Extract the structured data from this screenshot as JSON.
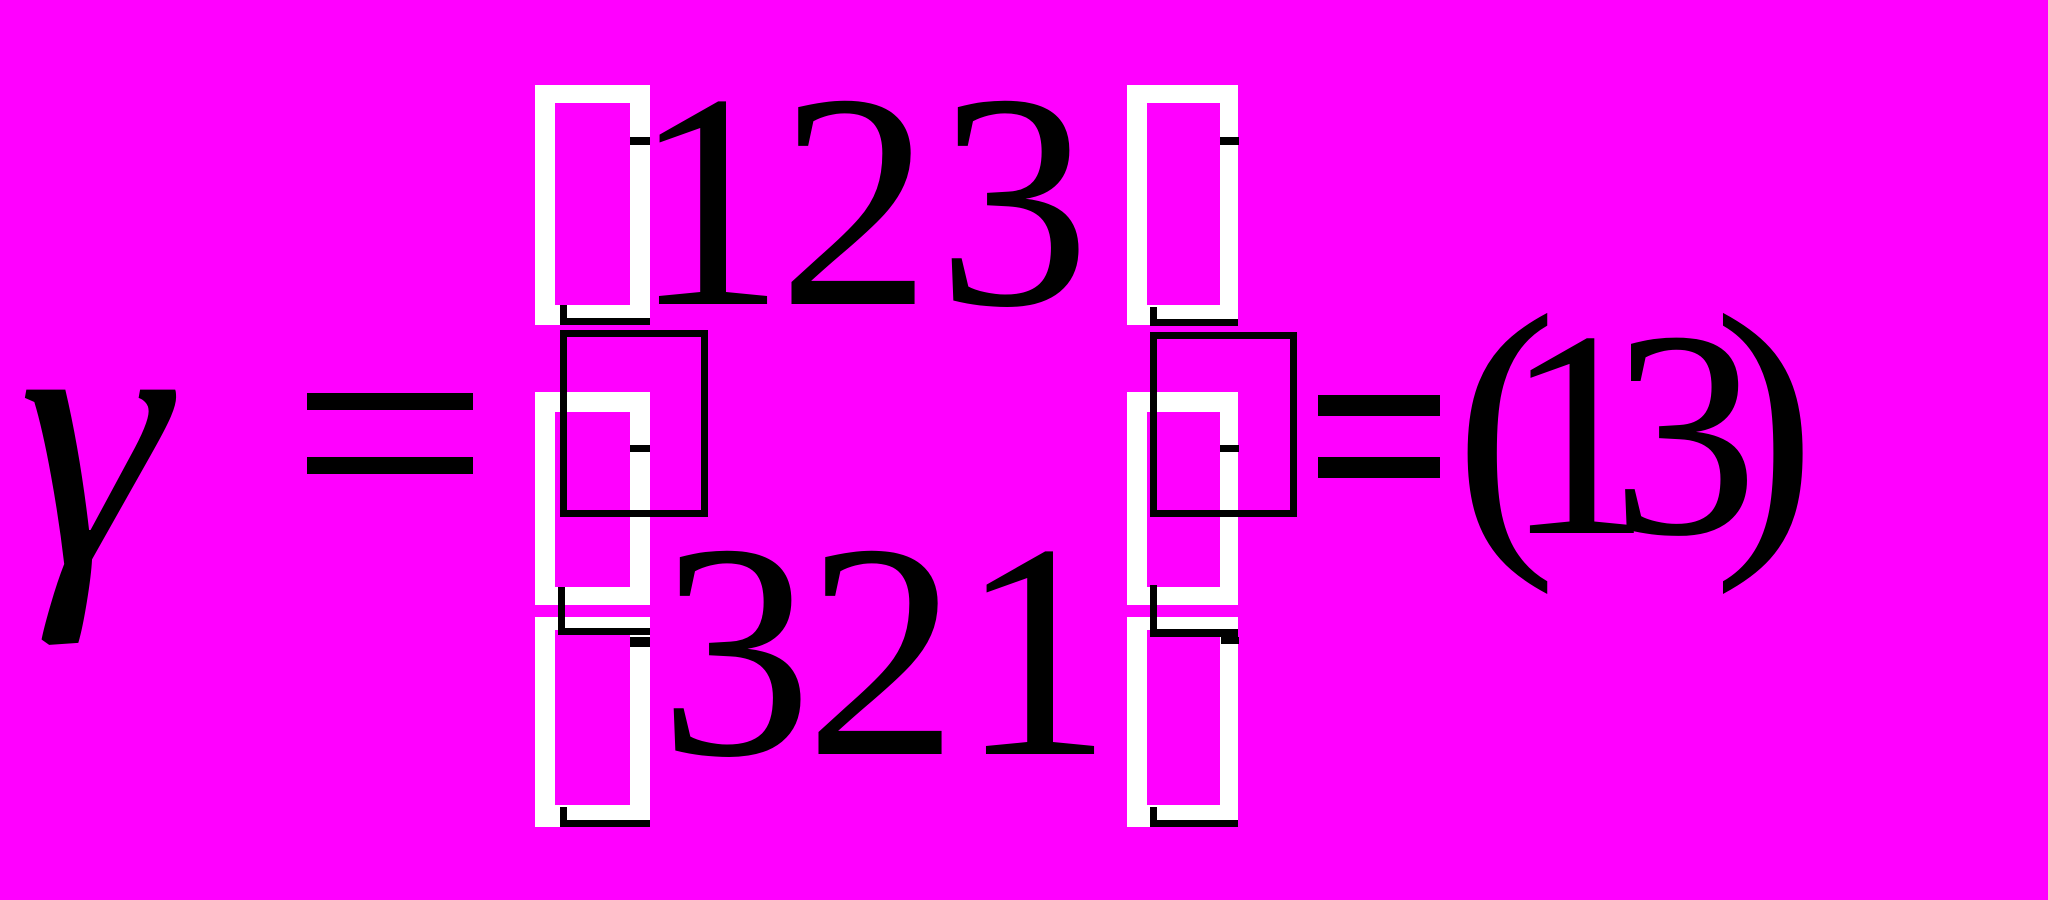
{
  "colors": {
    "background": "#FF00FF",
    "ink": "#000000",
    "missing_glyph_box": "#FFFFFF"
  },
  "formula": {
    "lhs_symbol": "γ",
    "equals_sign_1": "=",
    "matrix": {
      "rows": [
        [
          "1",
          "2",
          "3"
        ],
        [
          "3",
          "2",
          "1"
        ]
      ],
      "row1_text": "123",
      "row2_text": "321"
    },
    "equals_sign_2": "=",
    "result": {
      "chars": [
        "(",
        "1",
        "3",
        ")"
      ],
      "text": "(13)"
    }
  }
}
